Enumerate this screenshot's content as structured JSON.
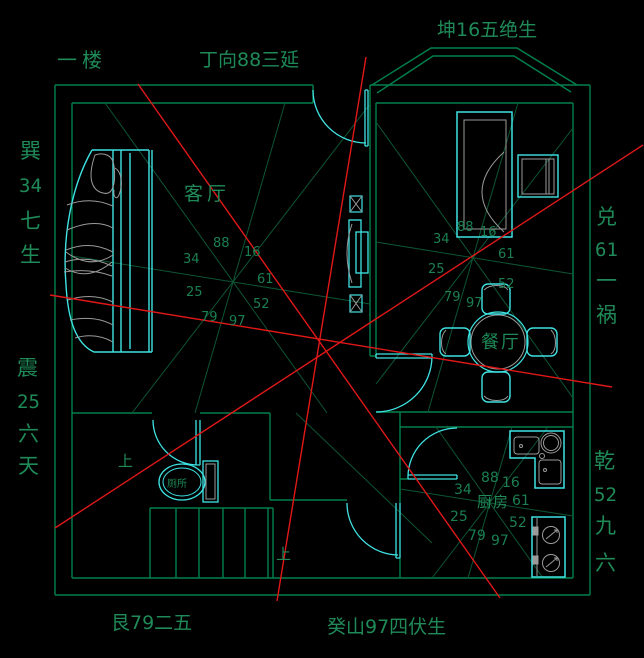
{
  "colors": {
    "background": "#000000",
    "wall_green": "#00804e",
    "construction_green": "#0d5434",
    "text_green": "#1f8a58",
    "furniture_cyan": "#3fe3e3",
    "detail_gray": "#9a9a9a",
    "red_line": "#e01818"
  },
  "title": {
    "floor": "一楼"
  },
  "compass": {
    "top": "丁向88三延",
    "top_right": "坤16五绝生",
    "bottom_left": "艮79二五",
    "bottom": "癸山97四伏生",
    "left_upper": [
      "巽",
      "34",
      "七",
      "生"
    ],
    "left_lower": [
      "震",
      "25",
      "六",
      "天"
    ],
    "right_upper": [
      "兑",
      "61",
      "一",
      "祸"
    ],
    "right_lower": [
      "乾",
      "52",
      "九",
      "六"
    ]
  },
  "rooms": {
    "living": "客厅",
    "dining": "餐厅",
    "kitchen": "厨房",
    "toilet": "厕所"
  },
  "stairs": {
    "up_label_1": "上",
    "up_label_2": "上"
  },
  "stars": {
    "living": [
      "88",
      "16",
      "34",
      "61",
      "25",
      "52",
      "79",
      "97"
    ],
    "dining": [
      "88",
      "16",
      "34",
      "61",
      "25",
      "52",
      "79",
      "97"
    ],
    "kitchen": [
      "88",
      "16",
      "34",
      "61",
      "25",
      "52",
      "79",
      "97"
    ]
  }
}
